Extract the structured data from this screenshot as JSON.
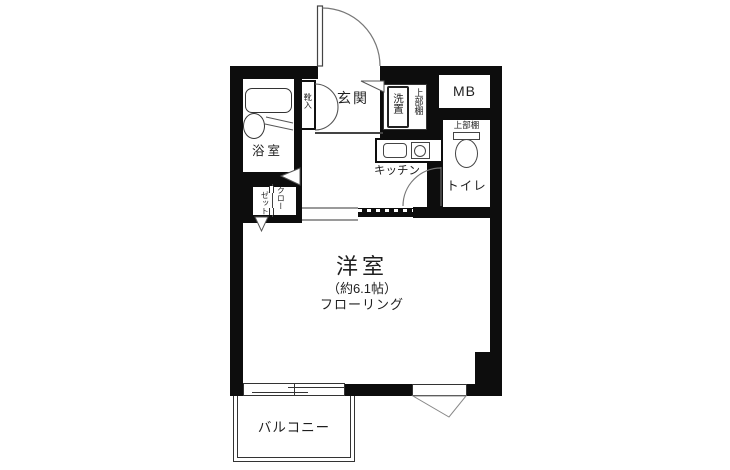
{
  "plan_type": "apartment-floor-plan",
  "labels": {
    "entrance": "玄関",
    "shoe_cabinet": "靴入",
    "washer_space": "洗置",
    "shelf_above_washer": "上部棚",
    "meter_box": "MB",
    "shelf_above_toilet": "上部棚",
    "toilet": "トイレ",
    "kitchen": "キッチン",
    "bathroom": "浴室",
    "closet_col_right": "クロー",
    "closet_col_left": "ゼット",
    "western_room": "洋室",
    "western_room_size": "（約6.1帖）",
    "western_room_flooring": "フローリング",
    "balcony": "バルコニー"
  },
  "colors": {
    "wall": "#0d0d0d",
    "fixture_line": "#555555",
    "text": "#1f1f1f",
    "background": "#ffffff"
  }
}
